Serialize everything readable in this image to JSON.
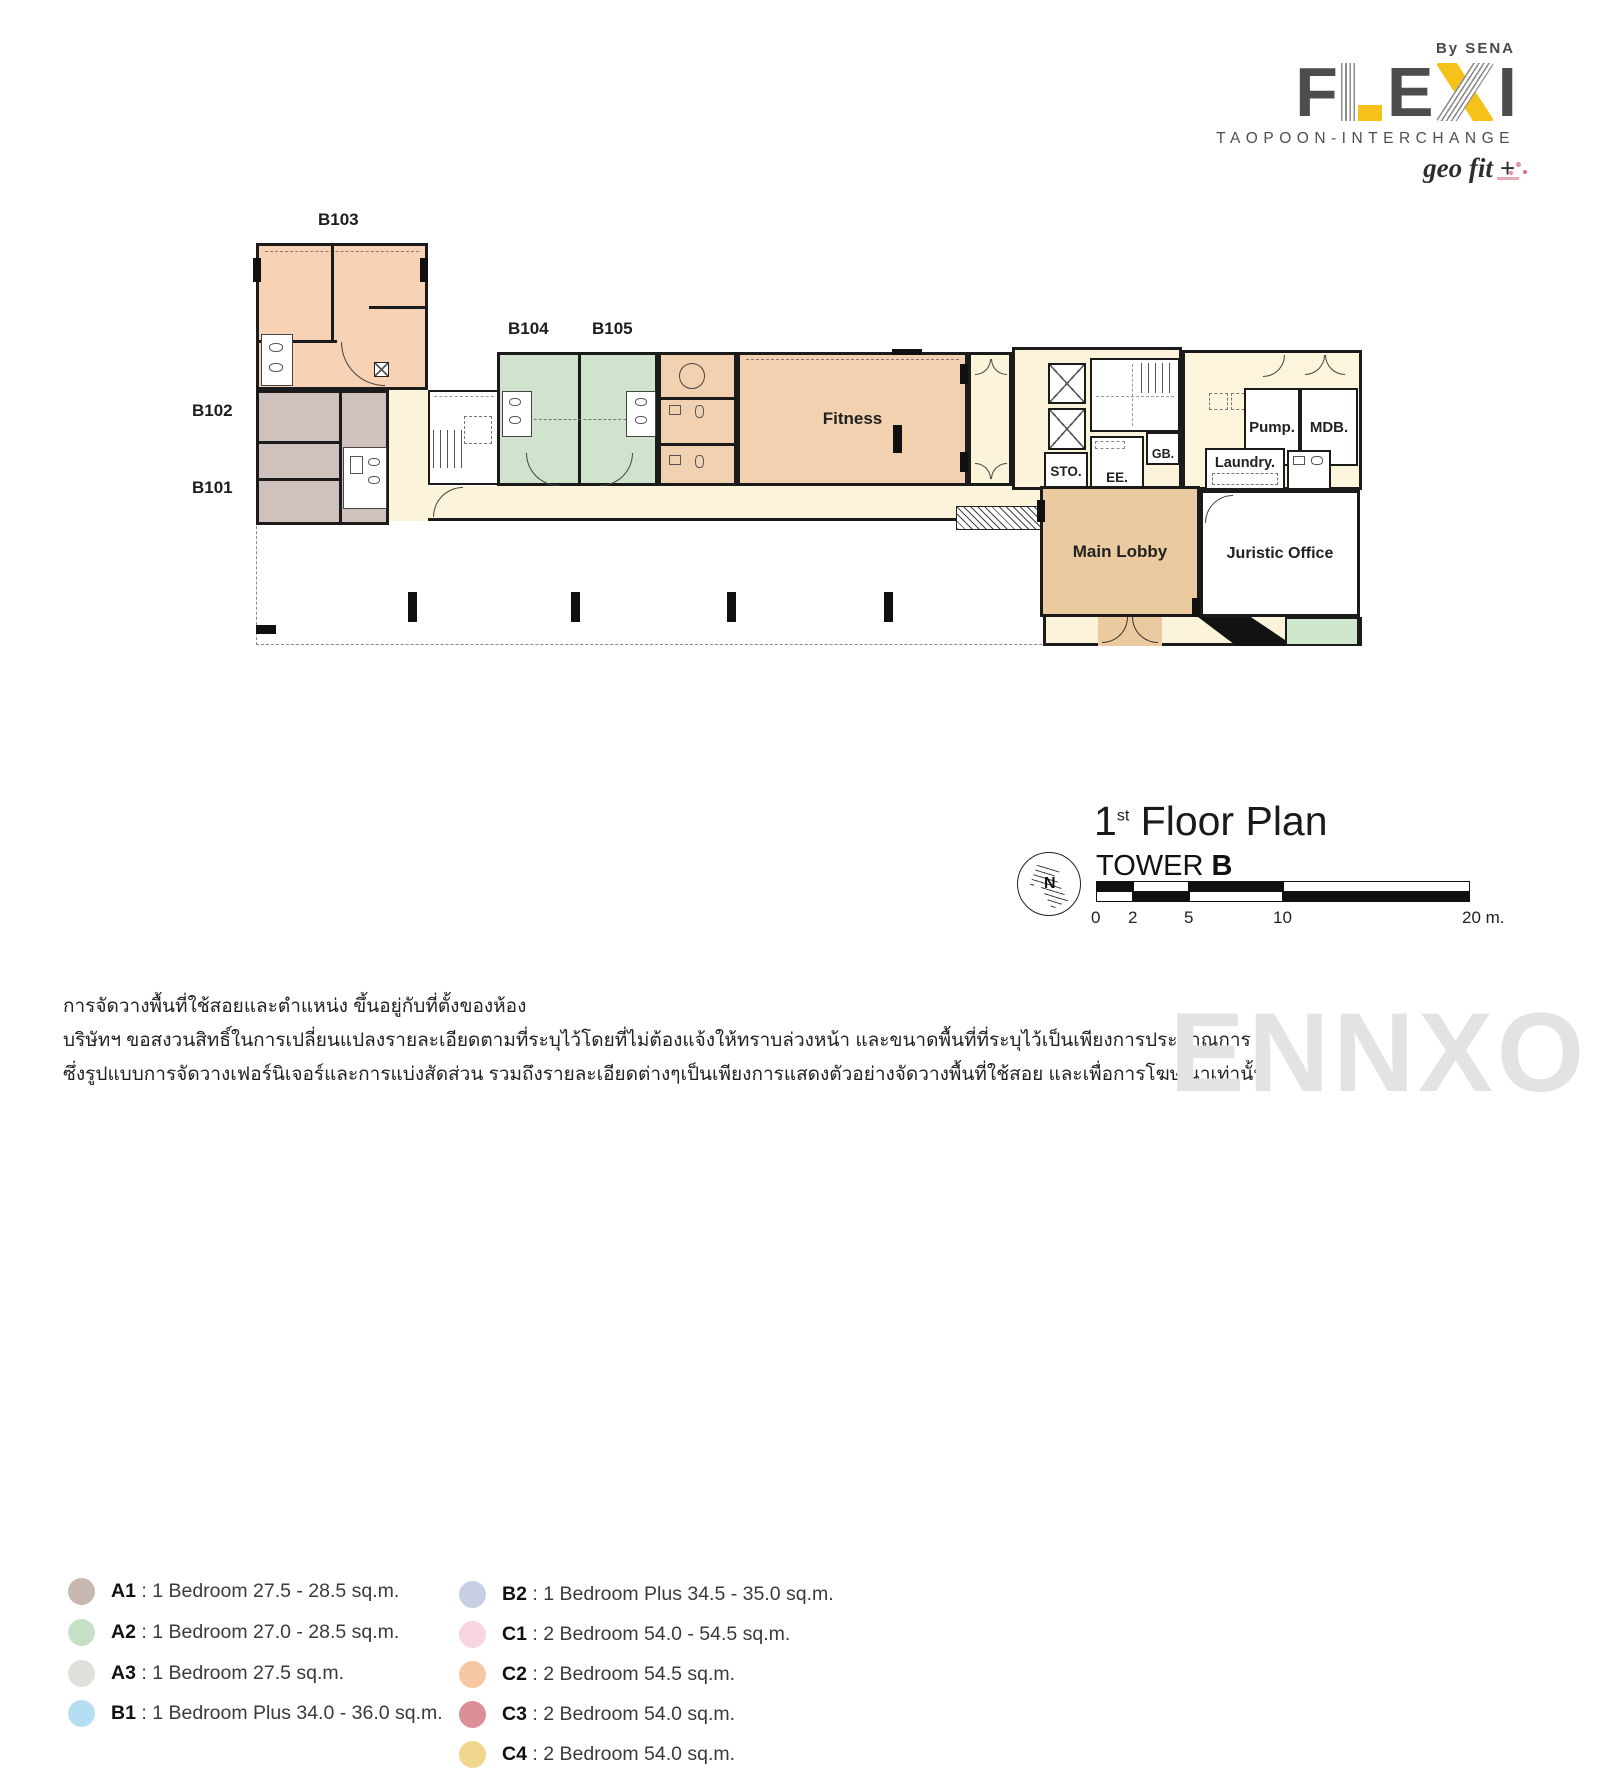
{
  "colors": {
    "wall": "#1b1b1b",
    "peach": "#f8d2b4",
    "taupe": "#cfc2bd",
    "green": "#cfe3cd",
    "tan": "#f1d1af",
    "lobby": "#ecca9f",
    "cream": "#fbf4da",
    "cream2": "#fcf5dc",
    "greenpatch": "#cfe8cd",
    "yellow": "#f6c21a",
    "logogray": "#4d4d4d",
    "watermark": "#e3e3e3"
  },
  "brand": {
    "by": "By SENA",
    "letters": {
      "f": "F",
      "l": "L",
      "e": "E",
      "x": "X",
      "i": "I"
    },
    "tagline": "TAOPOON-INTERCHANGE",
    "geofit": "geo fit +"
  },
  "plan": {
    "units": {
      "b101": "B101",
      "b102": "B102",
      "b103": "B103",
      "b104": "B104",
      "b105": "B105"
    },
    "rooms": {
      "fitness": "Fitness",
      "main_lobby": "Main Lobby",
      "juristic": "Juristic Office",
      "sto": "STO.",
      "ee": "EE.",
      "gb": "GB.",
      "laundry": "Laundry.",
      "pump": "Pump.",
      "mdb": "MDB."
    }
  },
  "legend": {
    "sep": " : ",
    "columns": [
      {
        "items": [
          {
            "code": "A1",
            "desc": "1 Bedroom 27.5 - 28.5 sq.m.",
            "color": "#c8b6b0"
          },
          {
            "code": "A2",
            "desc": "1 Bedroom 27.0 - 28.5 sq.m.",
            "color": "#c7e0c5"
          },
          {
            "code": "A3",
            "desc": "1 Bedroom 27.5 sq.m.",
            "color": "#dfe0da"
          },
          {
            "code": "B1",
            "desc": "1 Bedroom Plus 34.0 - 36.0 sq.m.",
            "color": "#b5def4"
          }
        ]
      },
      {
        "items": [
          {
            "code": "B2",
            "desc": "1 Bedroom Plus 34.5 - 35.0 sq.m.",
            "color": "#c8cee3"
          },
          {
            "code": "C1",
            "desc": "2 Bedroom 54.0 - 54.5 sq.m.",
            "color": "#f8d6e0"
          },
          {
            "code": "C2",
            "desc": "2 Bedroom 54.5 sq.m.",
            "color": "#f6c7a0"
          },
          {
            "code": "C3",
            "desc": "2 Bedroom 54.0 sq.m.",
            "color": "#db9098"
          },
          {
            "code": "C4",
            "desc": "2 Bedroom 54.0 sq.m.",
            "color": "#f1d68d"
          }
        ]
      }
    ]
  },
  "title": {
    "floor_num": "1",
    "floor_sup": "st",
    "floor_text": "Floor Plan",
    "tower_word": "TOWER",
    "tower_letter": "B",
    "compass_n": "N"
  },
  "scalebar": {
    "ticks": [
      "0",
      "2",
      "5",
      "10",
      "20 m."
    ]
  },
  "disclaimer": {
    "lines": [
      "การจัดวางพื้นที่ใช้สอยและตำแหน่ง ขึ้นอยู่กับที่ตั้งของห้อง",
      "บริษัทฯ ขอสงวนสิทธิ์ในการเปลี่ยนแปลงรายละเอียดตามที่ระบุไว้โดยที่ไม่ต้องแจ้งให้ทราบล่วงหน้า และขนาดพื้นที่ที่ระบุไว้เป็นเพียงการประมาณการ",
      "ซึ่งรูปแบบการจัดวางเฟอร์นิเจอร์และการแบ่งสัดส่วน รวมถึงรายละเอียดต่างๆเป็นเพียงการแสดงตัวอย่างจัดวางพื้นที่ใช้สอย และเพื่อการโฆษณาเท่านั้น"
    ]
  },
  "watermark": "ENNXO"
}
